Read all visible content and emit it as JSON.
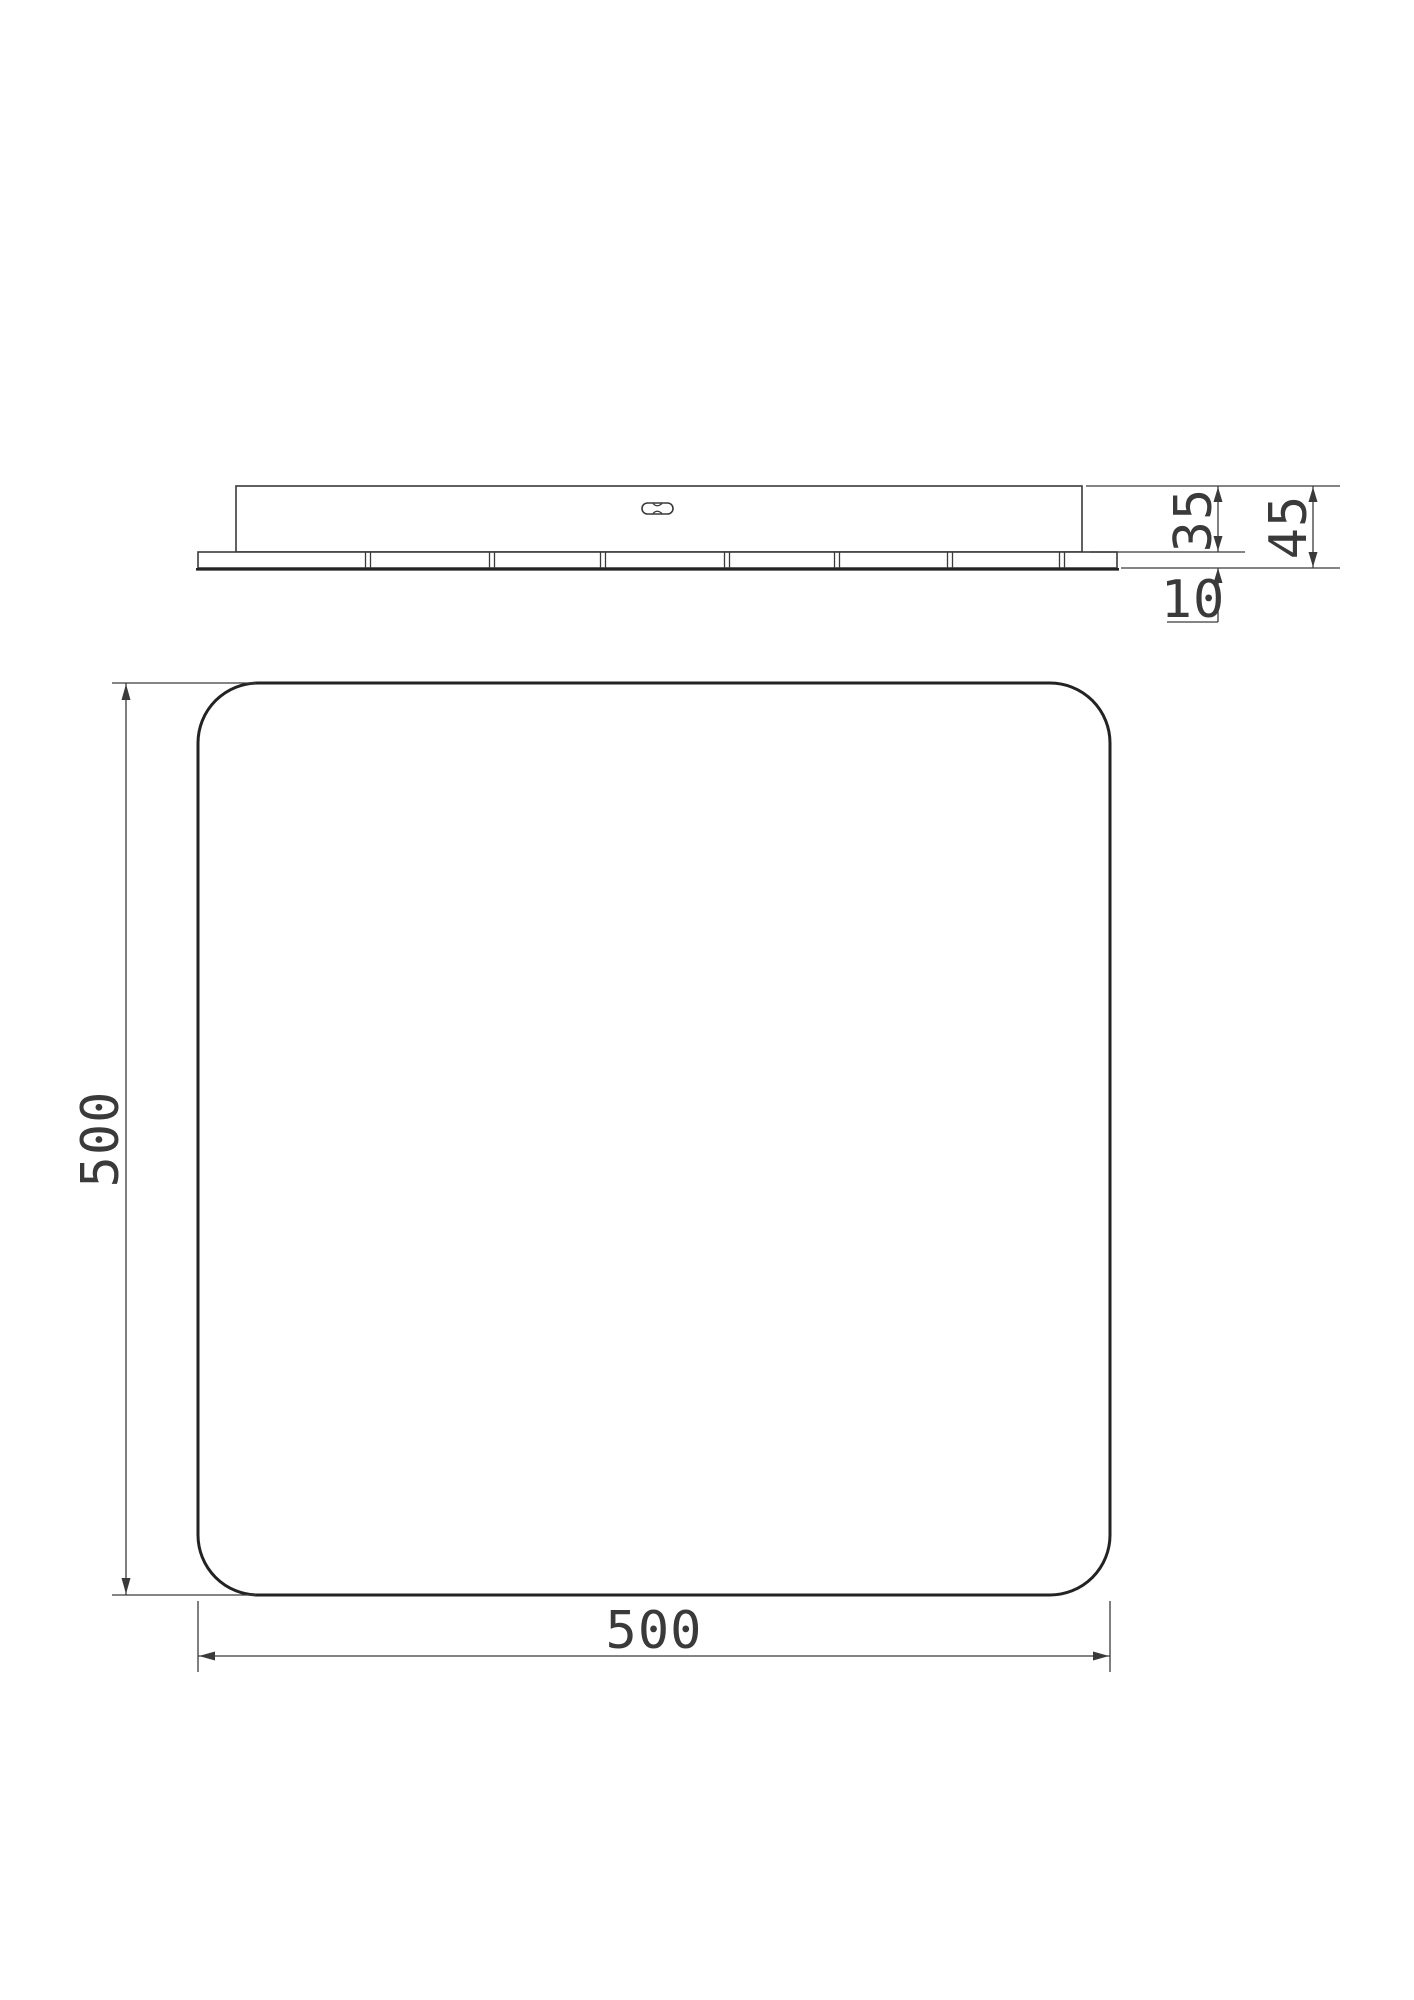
{
  "page": {
    "background": "#ffffff",
    "line_color": "#3a3a3a",
    "outline_color": "#232323",
    "text_color": "#3a3a3a",
    "stipple_color": "#b3b3b3"
  },
  "drawing": {
    "type": "technical-drawing",
    "views": [
      "side-elevation",
      "top-plan"
    ]
  },
  "dimensions": {
    "body_height": "35",
    "total_height": "45",
    "pad_height": "10",
    "panel_width": "500",
    "panel_height": "500"
  },
  "geometry": {
    "panel": {
      "x": 198,
      "y": 683,
      "size": 912,
      "corner_radius": 60
    },
    "hatch": {
      "start_c": -1016,
      "step": 118,
      "count": 13
    },
    "pad_divider_x": [
      368,
      492,
      603,
      727,
      837,
      950,
      1062
    ],
    "pad_strip": {
      "x": 198,
      "y": 552,
      "w": 919,
      "h": 16
    },
    "stipple": {
      "count": 270,
      "seed": 9
    }
  }
}
